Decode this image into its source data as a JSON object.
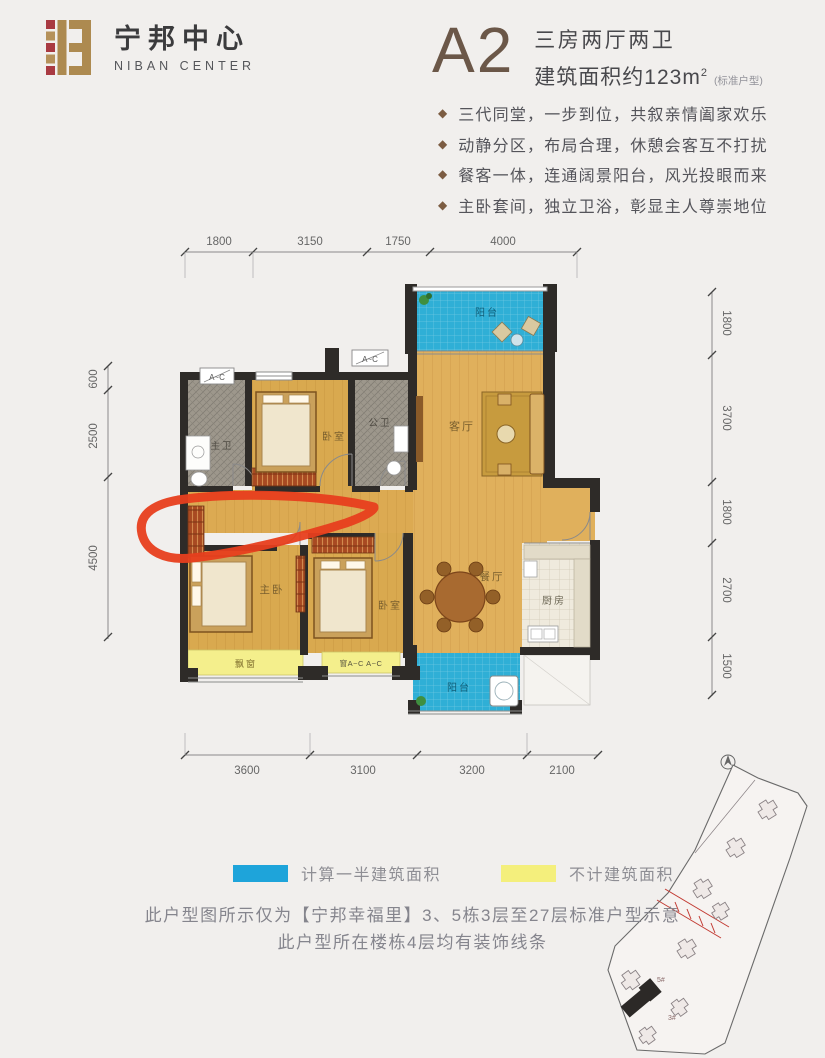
{
  "brand": {
    "cn": "宁邦中心",
    "en": "NIBAN CENTER"
  },
  "unit": {
    "code": "A2",
    "type_line": "三房两厅两卫",
    "area_main": "建筑面积约123m",
    "area_sup": "2",
    "area_note": "(标准户型)"
  },
  "features": [
    "三代同堂，一步到位，共叙亲情阖家欢乐",
    "动静分区，布局合理，休憩会客互不打扰",
    "餐客一体，连通阔景阳台，风光投眼而来",
    "主卧套间，独立卫浴，彰显主人尊崇地位"
  ],
  "rooms": {
    "master_bath": "主卫",
    "bedroom_top": "卧室",
    "guest_bath": "公卫",
    "living": "客厅",
    "balcony_top": "阳台",
    "master_bedroom": "主卧",
    "bedroom_mid": "卧室",
    "dining": "餐厅",
    "kitchen": "厨房",
    "balcony_bottom": "阳台",
    "bay_window": "飘窗",
    "window_tag": "A~C",
    "window_tag_wide": "窗A~C A~C"
  },
  "dims": {
    "top": [
      "1800",
      "3150",
      "1750",
      "4000"
    ],
    "bottom": [
      "3600",
      "3100",
      "3200",
      "2100"
    ],
    "left": [
      "600",
      "2500",
      "4500"
    ],
    "right": [
      "1800",
      "3700",
      "1800",
      "2700",
      "1500"
    ]
  },
  "legend": [
    {
      "label": "计算一半建筑面积",
      "color": "#1ea4da"
    },
    {
      "label": "不计建筑面积",
      "color": "#f4ef7c"
    }
  ],
  "notes": [
    "此户型图所示仅为【宁邦幸福里】3、5栋3层至27层标准户型示意",
    "此户型所在楼栋4层均有装饰线条"
  ],
  "siteplan": {
    "building_labels": [
      "5#",
      "3#"
    ]
  },
  "colors": {
    "accent_brown": "#6b5748",
    "balcony_blue": "#2fafd6",
    "bay_yellow": "#f4ef8c",
    "wall_dark": "#2e2b28",
    "marker_red": "#e73e1d"
  }
}
